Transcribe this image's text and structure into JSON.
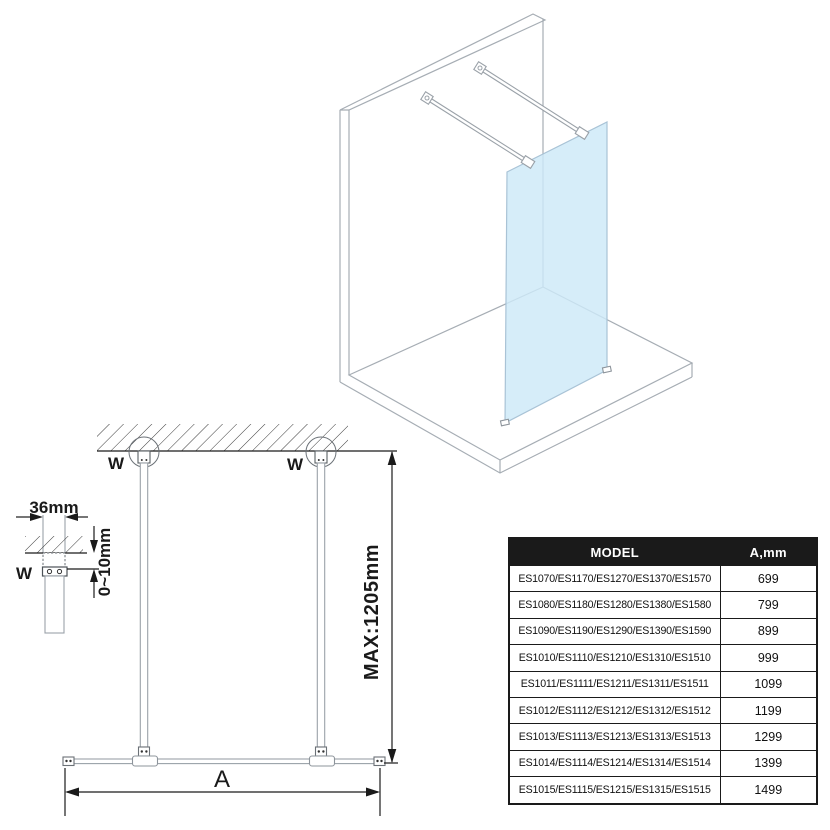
{
  "drawing": {
    "labels": {
      "wall_mount": "W",
      "dim_width": "36mm",
      "dim_gap": "0~10mm",
      "dim_height": "MAX:1205mm",
      "dim_span": "A"
    },
    "colors": {
      "glass": "#cde9f8",
      "iso_line": "#a6adb4",
      "structure_gray": "#9aa1a8",
      "dark": "#1a1a1a"
    }
  },
  "table": {
    "headers": {
      "model": "MODEL",
      "dimension": "A,mm"
    },
    "rows": [
      {
        "model": "ES1070/ES1170/ES1270/ES1370/ES1570",
        "a_mm": "699"
      },
      {
        "model": "ES1080/ES1180/ES1280/ES1380/ES1580",
        "a_mm": "799"
      },
      {
        "model": "ES1090/ES1190/ES1290/ES1390/ES1590",
        "a_mm": "899"
      },
      {
        "model": "ES1010/ES1110/ES1210/ES1310/ES1510",
        "a_mm": "999"
      },
      {
        "model": "ES1011/ES1111/ES1211/ES1311/ES1511",
        "a_mm": "1099"
      },
      {
        "model": "ES1012/ES1112/ES1212/ES1312/ES1512",
        "a_mm": "1199"
      },
      {
        "model": "ES1013/ES1113/ES1213/ES1313/ES1513",
        "a_mm": "1299"
      },
      {
        "model": "ES1014/ES1114/ES1214/ES1314/ES1514",
        "a_mm": "1399"
      },
      {
        "model": "ES1015/ES1115/ES1215/ES1315/ES1515",
        "a_mm": "1499"
      }
    ]
  }
}
